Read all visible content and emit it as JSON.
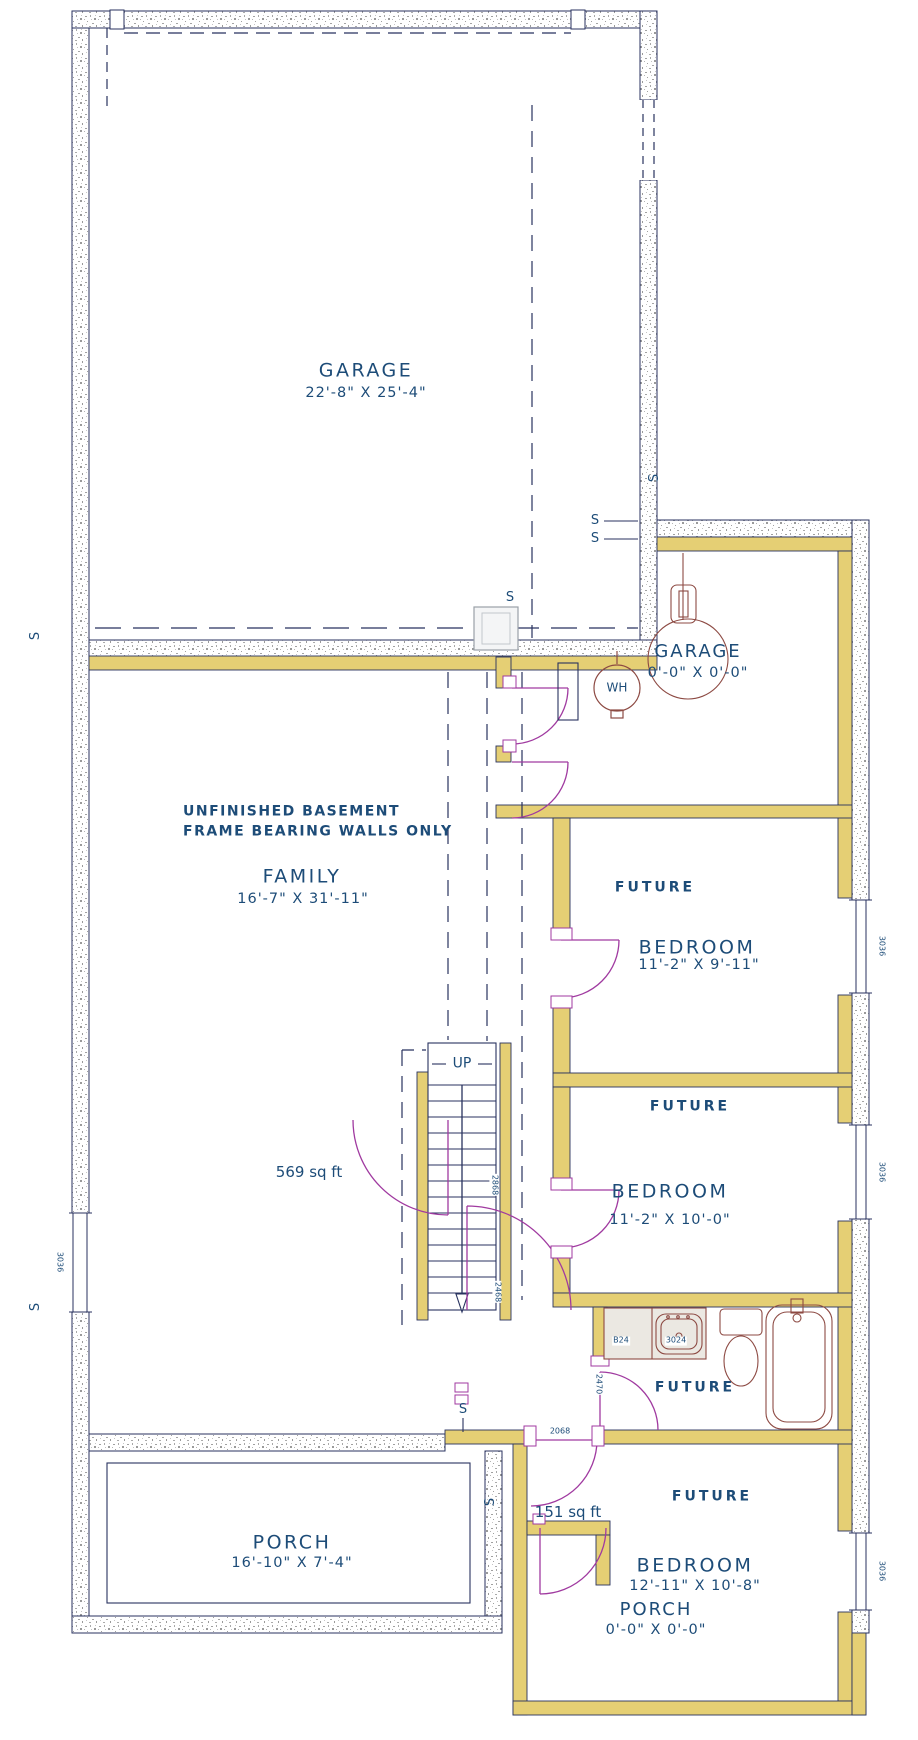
{
  "title": "Unfinished basement floor plan",
  "colors": {
    "text": "#1d4c78",
    "wall_line": "#28325f",
    "framed_wall": "#e5cf74",
    "door_swing": "#a03aa0",
    "fixture": "#8d4a43",
    "concrete_speck": "#a0a0a0"
  },
  "rooms": {
    "garage": {
      "name": "GARAGE",
      "dims": "22'-8\" X 25'-4\""
    },
    "garage_future": {
      "name": "GARAGE",
      "dims": "0'-0\" X 0'-0\""
    },
    "family": {
      "name": "FAMILY",
      "dims": "16'-7\" X 31'-11\""
    },
    "bedroom1": {
      "future": "FUTURE",
      "name": "BEDROOM",
      "dims": "11'-2\" X 9'-11\""
    },
    "bedroom2": {
      "future": "FUTURE",
      "name": "BEDROOM",
      "dims": "11'-2\" X 10'-0\""
    },
    "bath": {
      "future": "FUTURE"
    },
    "bedroom3": {
      "future": "FUTURE",
      "name": "BEDROOM",
      "dims": "12'-11\" X 10'-8\""
    },
    "porch": {
      "name": "PORCH",
      "dims": "16'-10\" X 7'-4\""
    },
    "porch_future": {
      "name": "PORCH",
      "dims": "0'-0\" X 0'-0\""
    }
  },
  "annotations": {
    "note_line1": "UNFINISHED BASEMENT",
    "note_line2": "FRAME BEARING WALLS ONLY",
    "up": "UP",
    "area_family": "569 sq ft",
    "area_hall": "151 sq ft",
    "water_heater": "WH",
    "switch": "S"
  },
  "codes": {
    "door_hall": "2868",
    "door_hall2": "2468",
    "door_bath_hall": "2068",
    "door_bath": "2470",
    "vanity_left": "B24",
    "vanity_sink": "3024",
    "window": "3036"
  }
}
